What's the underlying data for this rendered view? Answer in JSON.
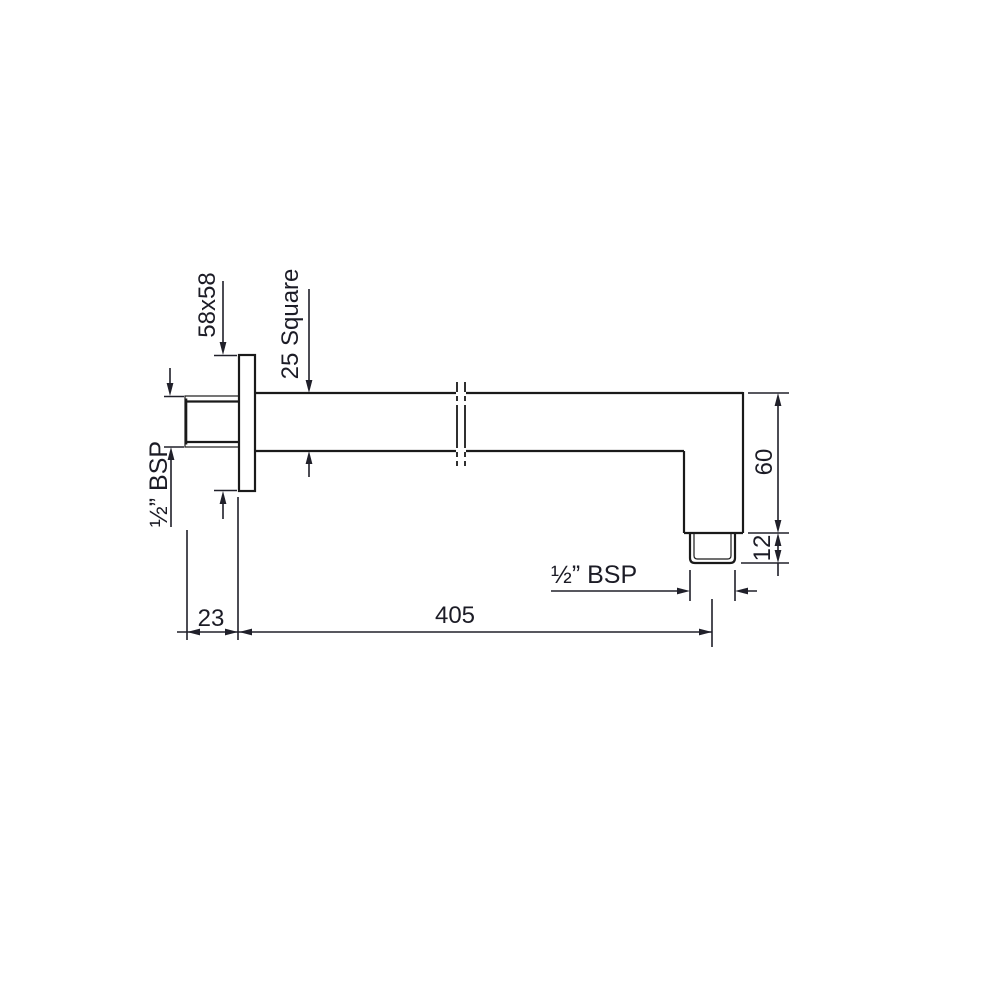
{
  "colors": {
    "background": "#ffffff",
    "outline": "#1a1a1a",
    "dimension": "#20202a"
  },
  "drawing": {
    "dimensions": {
      "flange_plate": "58x58",
      "tube_profile": "25 Square",
      "wall_thread": "½” BSP",
      "outlet_thread": "½” BSP",
      "drop": "60",
      "outlet_length": "12",
      "wall_clearance": "23",
      "reach": "405"
    }
  }
}
